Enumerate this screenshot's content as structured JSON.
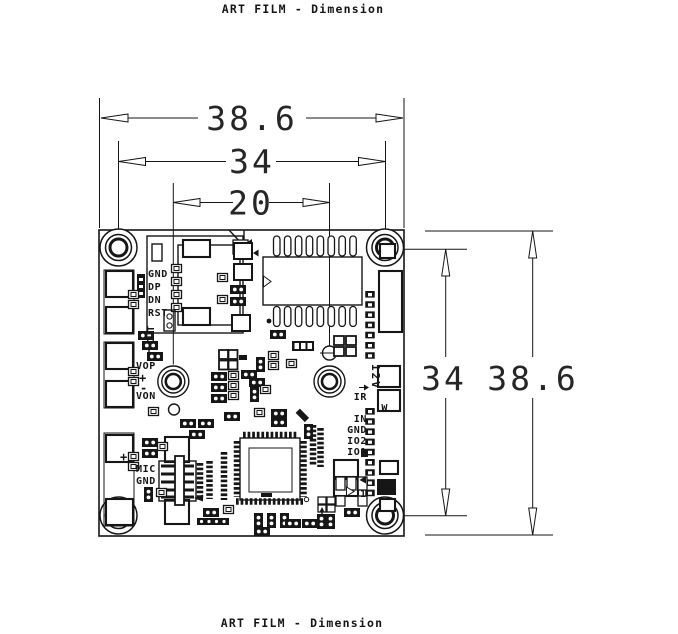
{
  "header": {
    "title": "ART FILM - Dimension"
  },
  "footer": {
    "title": "ART FILM - Dimension"
  },
  "dimensions": {
    "board_width": "38.6",
    "hole_span_width": "34",
    "inner_hole_span": "20",
    "hole_span_height": "34",
    "board_height": "38.6"
  },
  "silkscreen": {
    "usb_gnd": "GND",
    "usb_dp": "DP",
    "usb_dn": "DN",
    "usb_rst": "RST",
    "cut": "CUT",
    "vop": "VOP",
    "vop_plus": "+",
    "vop_minus": "-",
    "von": "VON",
    "mic_plus": "+",
    "mic": "MIC",
    "mic_gnd": "GND",
    "v12": "12V",
    "ir": "IR",
    "w": "W",
    "in": "IN",
    "gnd": "GND",
    "io2": "IO2",
    "io1": "IO1",
    "pin1": "1"
  },
  "colors": {
    "ink": "#161616",
    "background": "#ffffff"
  }
}
